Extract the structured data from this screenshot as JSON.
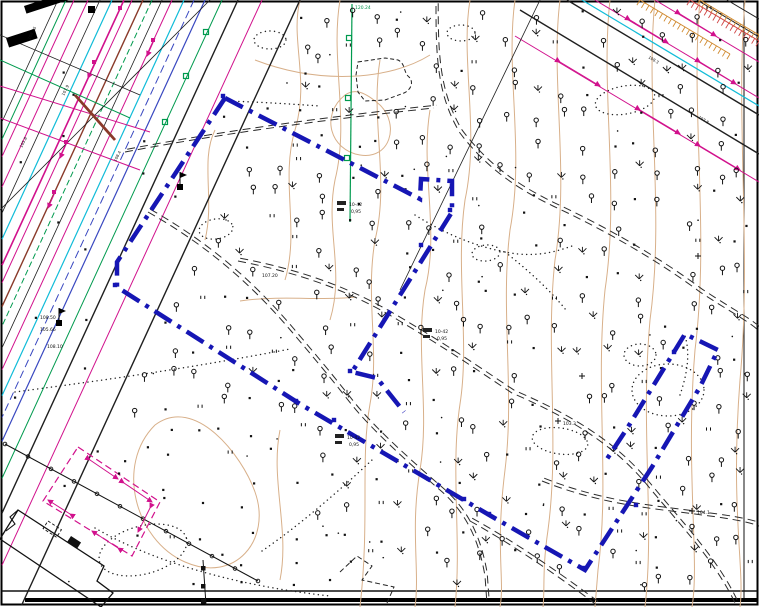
{
  "map": {
    "title": "topographic-survey-plan",
    "colors": {
      "paper": "#ffffff",
      "frame": "#000000",
      "contour": "#d8b08a",
      "black": "#1f1f1f",
      "magenta": "#d1118c",
      "green": "#009a4e",
      "cyan": "#10bcd8",
      "blue_utility": "#3948c0",
      "brown": "#8a3a2a",
      "boundary_blue": "#1616b4",
      "orange": "#d08a30",
      "red_hatch": "#d04545"
    },
    "boundary": {
      "color": "#1616b4",
      "width": 4.5,
      "dash": "20 7 4 7",
      "paths": [
        "M225,98 L117,262 L117,287 L300,404 L491,516 L585,570 L652,467 L700,387 L718,350 L685,334 L628,427 L605,462",
        "M225,98 L420,199 L421,179 L452,181 L452,212 L352,372 L377,378 L404,412"
      ],
      "squares": [
        [
          115,
          285
        ],
        [
          223,
          96
        ],
        [
          450,
          210
        ],
        [
          350,
          371
        ],
        [
          583,
          568
        ],
        [
          636,
          505
        ],
        [
          674,
          352
        ],
        [
          334,
          420
        ],
        [
          464,
          499
        ],
        [
          421,
          245
        ],
        [
          296,
          401
        ],
        [
          489,
          514
        ]
      ]
    },
    "contours": [
      "M300,0 C290,40 310,80 295,130 C280,180 300,230 285,280",
      "M340,0 C330,60 350,120 335,180 C325,230 345,270 330,320",
      "M380,60 C370,120 390,180 375,240 C365,300 380,350 370,404 C360,460 370,520 360,607",
      "M430,110 C420,170 440,230 425,290 C415,350 430,410 420,470 C410,530 420,570 415,607",
      "M470,0 C460,60 480,130 465,200 C455,270 470,340 460,404 C450,470 462,540 455,607",
      "M515,0 C505,70 525,150 510,230 C500,310 515,390 505,470 C495,550 505,580 500,607",
      "M560,0 C550,80 570,170 555,260 C545,350 560,440 548,530 C542,570 545,590 543,607",
      "M610,0 C600,90 620,190 605,290 C595,390 610,480 598,570 L595,607",
      "M655,0 C645,100 665,210 650,320 C640,430 655,520 645,607",
      "M700,0 C690,110 710,230 695,350 C685,470 700,560 692,607",
      "M745,0 C735,120 752,250 740,380 C730,510 745,570 740,607",
      "M255,60 C320,85 390,80 430,55",
      "M155,425 C115,465 135,540 185,562 C235,584 272,540 255,492 C242,455 195,395 155,425",
      "M345,95 C320,115 330,150 360,155 C390,160 400,125 380,105 C365,92 355,88 345,95",
      "M215,130 C200,160 215,200 205,240",
      "M280,430 C270,480 290,530 280,580",
      "M240,301 C280,295 320,301 356,297"
    ],
    "corridor": {
      "comment": "parallel utility lines upper-left, x at y=0, direction (-0.46,1)",
      "lines": [
        {
          "x0": 58,
          "c": "black",
          "w": 0.8
        },
        {
          "x0": 66,
          "c": "green",
          "w": 1
        },
        {
          "x0": 74,
          "c": "magenta",
          "w": 1
        },
        {
          "x0": 88,
          "c": "magenta",
          "w": 1
        },
        {
          "x0": 100,
          "c": "black",
          "w": 0.8
        },
        {
          "x0": 112,
          "c": "cyan",
          "w": 1.2
        },
        {
          "x0": 124,
          "c": "magenta",
          "w": 1.6
        },
        {
          "x0": 132,
          "c": "magenta",
          "w": 1
        },
        {
          "x0": 143,
          "c": "brown",
          "w": 1.4
        },
        {
          "x0": 152,
          "c": "green",
          "w": 1,
          "da": "6 3"
        },
        {
          "x0": 162,
          "c": "black",
          "w": 0.8
        },
        {
          "x0": 172,
          "c": "magenta",
          "w": 1
        },
        {
          "x0": 184,
          "c": "cyan",
          "w": 1.2
        },
        {
          "x0": 194,
          "c": "blue_utility",
          "w": 1,
          "da": "8 4"
        },
        {
          "x0": 205,
          "c": "blue_utility",
          "w": 1.2
        },
        {
          "x0": 222,
          "c": "green",
          "w": 1
        },
        {
          "x0": 238,
          "c": "black",
          "w": 1.4
        },
        {
          "x0": 262,
          "c": "magenta",
          "w": 1
        },
        {
          "x0": 300,
          "c": "black",
          "w": 1.4
        }
      ],
      "cross_lines": [
        {
          "d": "M0,35 L140,95",
          "c": "black",
          "w": 0.8
        },
        {
          "d": "M0,86 L150,132",
          "c": "magenta",
          "w": 1
        },
        {
          "d": "M0,118 L140,170",
          "c": "magenta",
          "w": 1
        },
        {
          "d": "M0,60 L130,118",
          "c": "green",
          "w": 1
        },
        {
          "d": "M210,0 L0,210",
          "c": "black",
          "w": 0.8
        },
        {
          "d": "M75,95 L115,140",
          "c": "brown",
          "w": 2.8
        }
      ]
    },
    "topright_lines": [
      {
        "d": "M520,10 L759,154",
        "c": "black",
        "w": 1.4
      },
      {
        "d": "M567,0 L759,115",
        "c": "black",
        "w": 1.4
      },
      {
        "d": "M697,0 L759,37",
        "c": "black",
        "w": 1
      },
      {
        "d": "M727,0 L759,19",
        "c": "black",
        "w": 1
      },
      {
        "d": "M582,0 L759,106",
        "c": "cyan",
        "w": 1.2
      },
      {
        "d": "M515,36 L759,182",
        "c": "magenta",
        "w": 1
      },
      {
        "d": "M595,0 L759,98",
        "c": "magenta",
        "w": 1
      },
      {
        "d": "M655,0 L759,62",
        "c": "magenta",
        "w": 1
      },
      {
        "d": "M540,0 L400,290",
        "c": "black",
        "w": 0.8
      },
      {
        "d": "M352,4 L350,222",
        "c": "green",
        "w": 1.2
      }
    ],
    "combs": [
      {
        "x1": 640,
        "y1": 0,
        "x2": 730,
        "y2": 54,
        "c": "orange"
      },
      {
        "x1": 700,
        "y1": 0,
        "x2": 759,
        "y2": 35,
        "c": "orange"
      },
      {
        "x1": 690,
        "y1": 0,
        "x2": 759,
        "y2": 41,
        "c": "red_hatch"
      }
    ],
    "roads_double_dashed": [
      "M436,6 C436,55 437,95 460,133 C488,170 520,190 553,206 C605,230 660,262 700,292 C732,313 750,322 759,331",
      "M125,152 C225,133 330,119 434,108",
      "M238,261 C300,273 350,291 398,320 C455,354 480,372 512,393 C565,416 612,442 648,486 C682,527 716,562 736,605",
      "M148,212 C215,250 258,292 292,332 C326,372 337,386 352,405 C372,430 412,466 440,490 C467,513 479,541 485,576 L487,604",
      "M470,521 C510,543 560,577 598,606",
      "M542,481 C605,506 660,509 702,515 C735,519 752,523 759,526"
    ],
    "dotted_paths": [
      "M15,392 C90,382 180,370 290,349",
      "M95,528 C150,560 230,585 330,596",
      "M262,551 C300,525 340,490 372,460",
      "M415,215 C450,237 480,247 505,252 C535,258 555,252 572,246",
      "M505,252 C528,270 550,290 566,310",
      "M225,101 C260,102 290,104 320,106",
      "M680,395 C688,372 690,352 685,336"
    ],
    "dotted_ellipses": [
      [
        143,
        550,
        45,
        24,
        -15
      ],
      [
        461,
        33,
        14,
        8,
        0
      ],
      [
        625,
        100,
        30,
        14,
        -10
      ],
      [
        640,
        355,
        16,
        11,
        0
      ],
      [
        668,
        390,
        36,
        26,
        0
      ],
      [
        486,
        253,
        14,
        8,
        -5
      ],
      [
        560,
        441,
        28,
        13,
        8
      ],
      [
        216,
        229,
        17,
        10,
        -8
      ],
      [
        270,
        40,
        16,
        9,
        0
      ]
    ],
    "fence": {
      "x1": 5,
      "y1": 444,
      "x2": 258,
      "y2": 581,
      "posts": 11
    },
    "vfence": {
      "d": "M203,560 L206,605",
      "squares": [
        [
          201,
          566
        ],
        [
          201,
          584
        ],
        [
          201,
          599
        ]
      ]
    },
    "building": {
      "outline": "M18,510 L104,566 L97,581 L113,593 L101,607 L0,539 Z",
      "notch": "M18,510 L10,517 L15,524 L6,531",
      "dashed_rect": {
        "x": 48,
        "y": 521,
        "w": 16,
        "h": 9,
        "rot": 33
      },
      "solid_rect": {
        "x": 71,
        "y": 536,
        "w": 12,
        "h": 7,
        "rot": 33
      }
    },
    "dashed_blob": "M358,62 L385,58 L398,60 C406,64 403,72 409,77 C414,82 411,90 404,93 L385,100 L365,101 L358,92 L356,75 Z",
    "zigzag": "M340,572 L357,556 L372,566 L362,580 L394,587 L387,603",
    "magenta_area": {
      "outline": "M78,447 L160,502 L132,556 L43,501 Z",
      "arrows": [
        [
          90,
          460,
          118,
          479
        ],
        [
          124,
          483,
          152,
          502
        ],
        [
          150,
          508,
          138,
          532
        ],
        [
          118,
          548,
          92,
          531
        ],
        [
          70,
          514,
          48,
          500
        ]
      ]
    },
    "magenta_corridor_arrows": [
      [
        96,
        60,
        88,
        78
      ],
      [
        68,
        140,
        60,
        158
      ],
      [
        155,
        38,
        147,
        56
      ],
      [
        56,
        190,
        48,
        208
      ]
    ],
    "topright_arrows": [
      [
        560,
        62,
        600,
        86
      ],
      [
        640,
        110,
        680,
        134
      ],
      [
        700,
        146,
        740,
        170
      ],
      [
        630,
        20,
        668,
        43
      ],
      [
        700,
        62,
        736,
        84
      ],
      [
        680,
        14,
        716,
        36
      ]
    ],
    "green_squares": [
      [
        206,
        32
      ],
      [
        186,
        76
      ],
      [
        165,
        122
      ],
      [
        349,
        38
      ],
      [
        348,
        98
      ],
      [
        347,
        158
      ]
    ],
    "magenta_squares": [
      [
        94,
        62
      ],
      [
        66,
        142
      ],
      [
        153,
        40
      ],
      [
        54,
        192
      ],
      [
        120,
        8
      ]
    ],
    "flags": [
      {
        "x": 59,
        "y": 323
      },
      {
        "x": 180,
        "y": 187
      }
    ],
    "black_bars": [
      {
        "x": 24,
        "y": 6,
        "w": 52,
        "h": 8,
        "rot": -18
      },
      {
        "x": 6,
        "y": 38,
        "w": 30,
        "h": 10,
        "rot": -18
      },
      {
        "x": 88,
        "y": 6,
        "w": 7,
        "h": 7,
        "rot": 0
      }
    ],
    "frame": {
      "right_line_x": 744,
      "neatline_y": 591,
      "bottom_bar_y": 598,
      "bottom_bar_x1": 25
    },
    "labels": [
      {
        "t": "10-42",
        "x": 349,
        "y": 206,
        "s": 4.5
      },
      {
        "t": "0,95",
        "x": 351,
        "y": 213,
        "s": 4.5
      },
      {
        "t": "10-42",
        "x": 435,
        "y": 333,
        "s": 4.5
      },
      {
        "t": "0,95",
        "x": 437,
        "y": 340,
        "s": 4.5
      },
      {
        "t": "10-42",
        "x": 347,
        "y": 439,
        "s": 4.5
      },
      {
        "t": "0,95",
        "x": 349,
        "y": 446,
        "s": 4.5
      },
      {
        "t": "104.1",
        "x": 697,
        "y": 514,
        "s": 4.5
      },
      {
        "t": "103.3",
        "x": 563,
        "y": 425,
        "s": 4.5
      },
      {
        "t": "107.20",
        "x": 262,
        "y": 277,
        "s": 4.5
      },
      {
        "t": "108.50",
        "x": 40,
        "y": 319,
        "s": 4.5
      },
      {
        "t": "105.66",
        "x": 40,
        "y": 331,
        "s": 4.5
      },
      {
        "t": "108.10",
        "x": 47,
        "y": 348,
        "s": 4.5
      },
      {
        "t": "108.25",
        "x": 30,
        "y": 40,
        "s": 4,
        "r": -63
      },
      {
        "t": "107.9",
        "x": 64,
        "y": 96,
        "s": 4,
        "r": -63
      },
      {
        "t": "108.4",
        "x": 116,
        "y": 162,
        "s": 4,
        "r": -63
      },
      {
        "t": "105.8",
        "x": 22,
        "y": 148,
        "s": 4,
        "r": -63
      },
      {
        "t": "108.3",
        "x": 648,
        "y": 58,
        "s": 4,
        "r": 31
      },
      {
        "t": "107.8",
        "x": 698,
        "y": 118,
        "s": 4,
        "r": 31
      },
      {
        "t": "120.24",
        "x": 355,
        "y": 9,
        "s": 4.5,
        "c": "#00914a"
      }
    ],
    "label_smudges": [
      [
        337,
        201,
        9,
        4
      ],
      [
        337,
        208,
        7,
        3
      ],
      [
        423,
        328,
        9,
        4
      ],
      [
        423,
        335,
        7,
        3
      ],
      [
        335,
        434,
        9,
        4
      ],
      [
        335,
        441,
        7,
        3
      ]
    ],
    "crosses": [
      [
        692,
        511
      ],
      [
        558,
        421
      ],
      [
        582,
        376
      ],
      [
        698,
        256
      ]
    ],
    "symbols": {
      "seed": 7,
      "grid": 26,
      "jitter": 18,
      "corridor_band": [
        35,
        315
      ],
      "weights_field": {
        "tree": 0.38,
        "bush": 0.52,
        "dot": 0.74,
        "tick": 0.86
      },
      "bottom_left": {
        "x_max": 300,
        "y_min": 420,
        "dot": 0.45,
        "tick": 0.6
      }
    }
  }
}
